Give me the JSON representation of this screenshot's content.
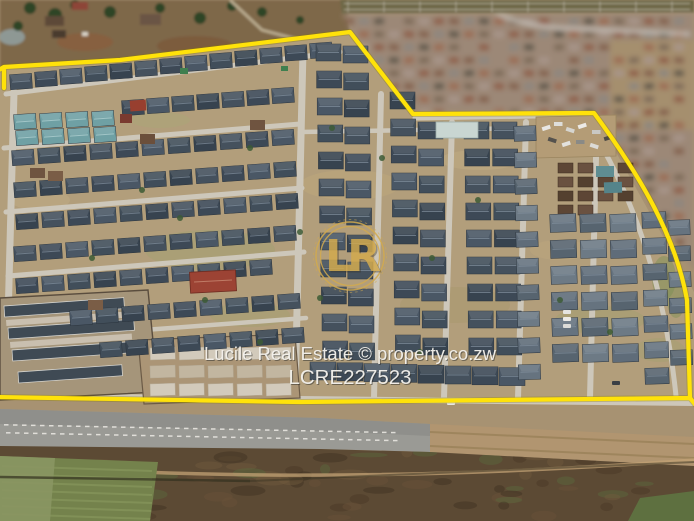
{
  "watermark": {
    "brand_line": "Lucile Real Estate © property.co.zw",
    "listing_code": "LCRE227523",
    "logo_monogram": "LR"
  },
  "colors": {
    "boundary_yellow": "#ffe20a",
    "logo_gold": "#d2aa4e",
    "watermark_text": "#f5f3ee"
  }
}
